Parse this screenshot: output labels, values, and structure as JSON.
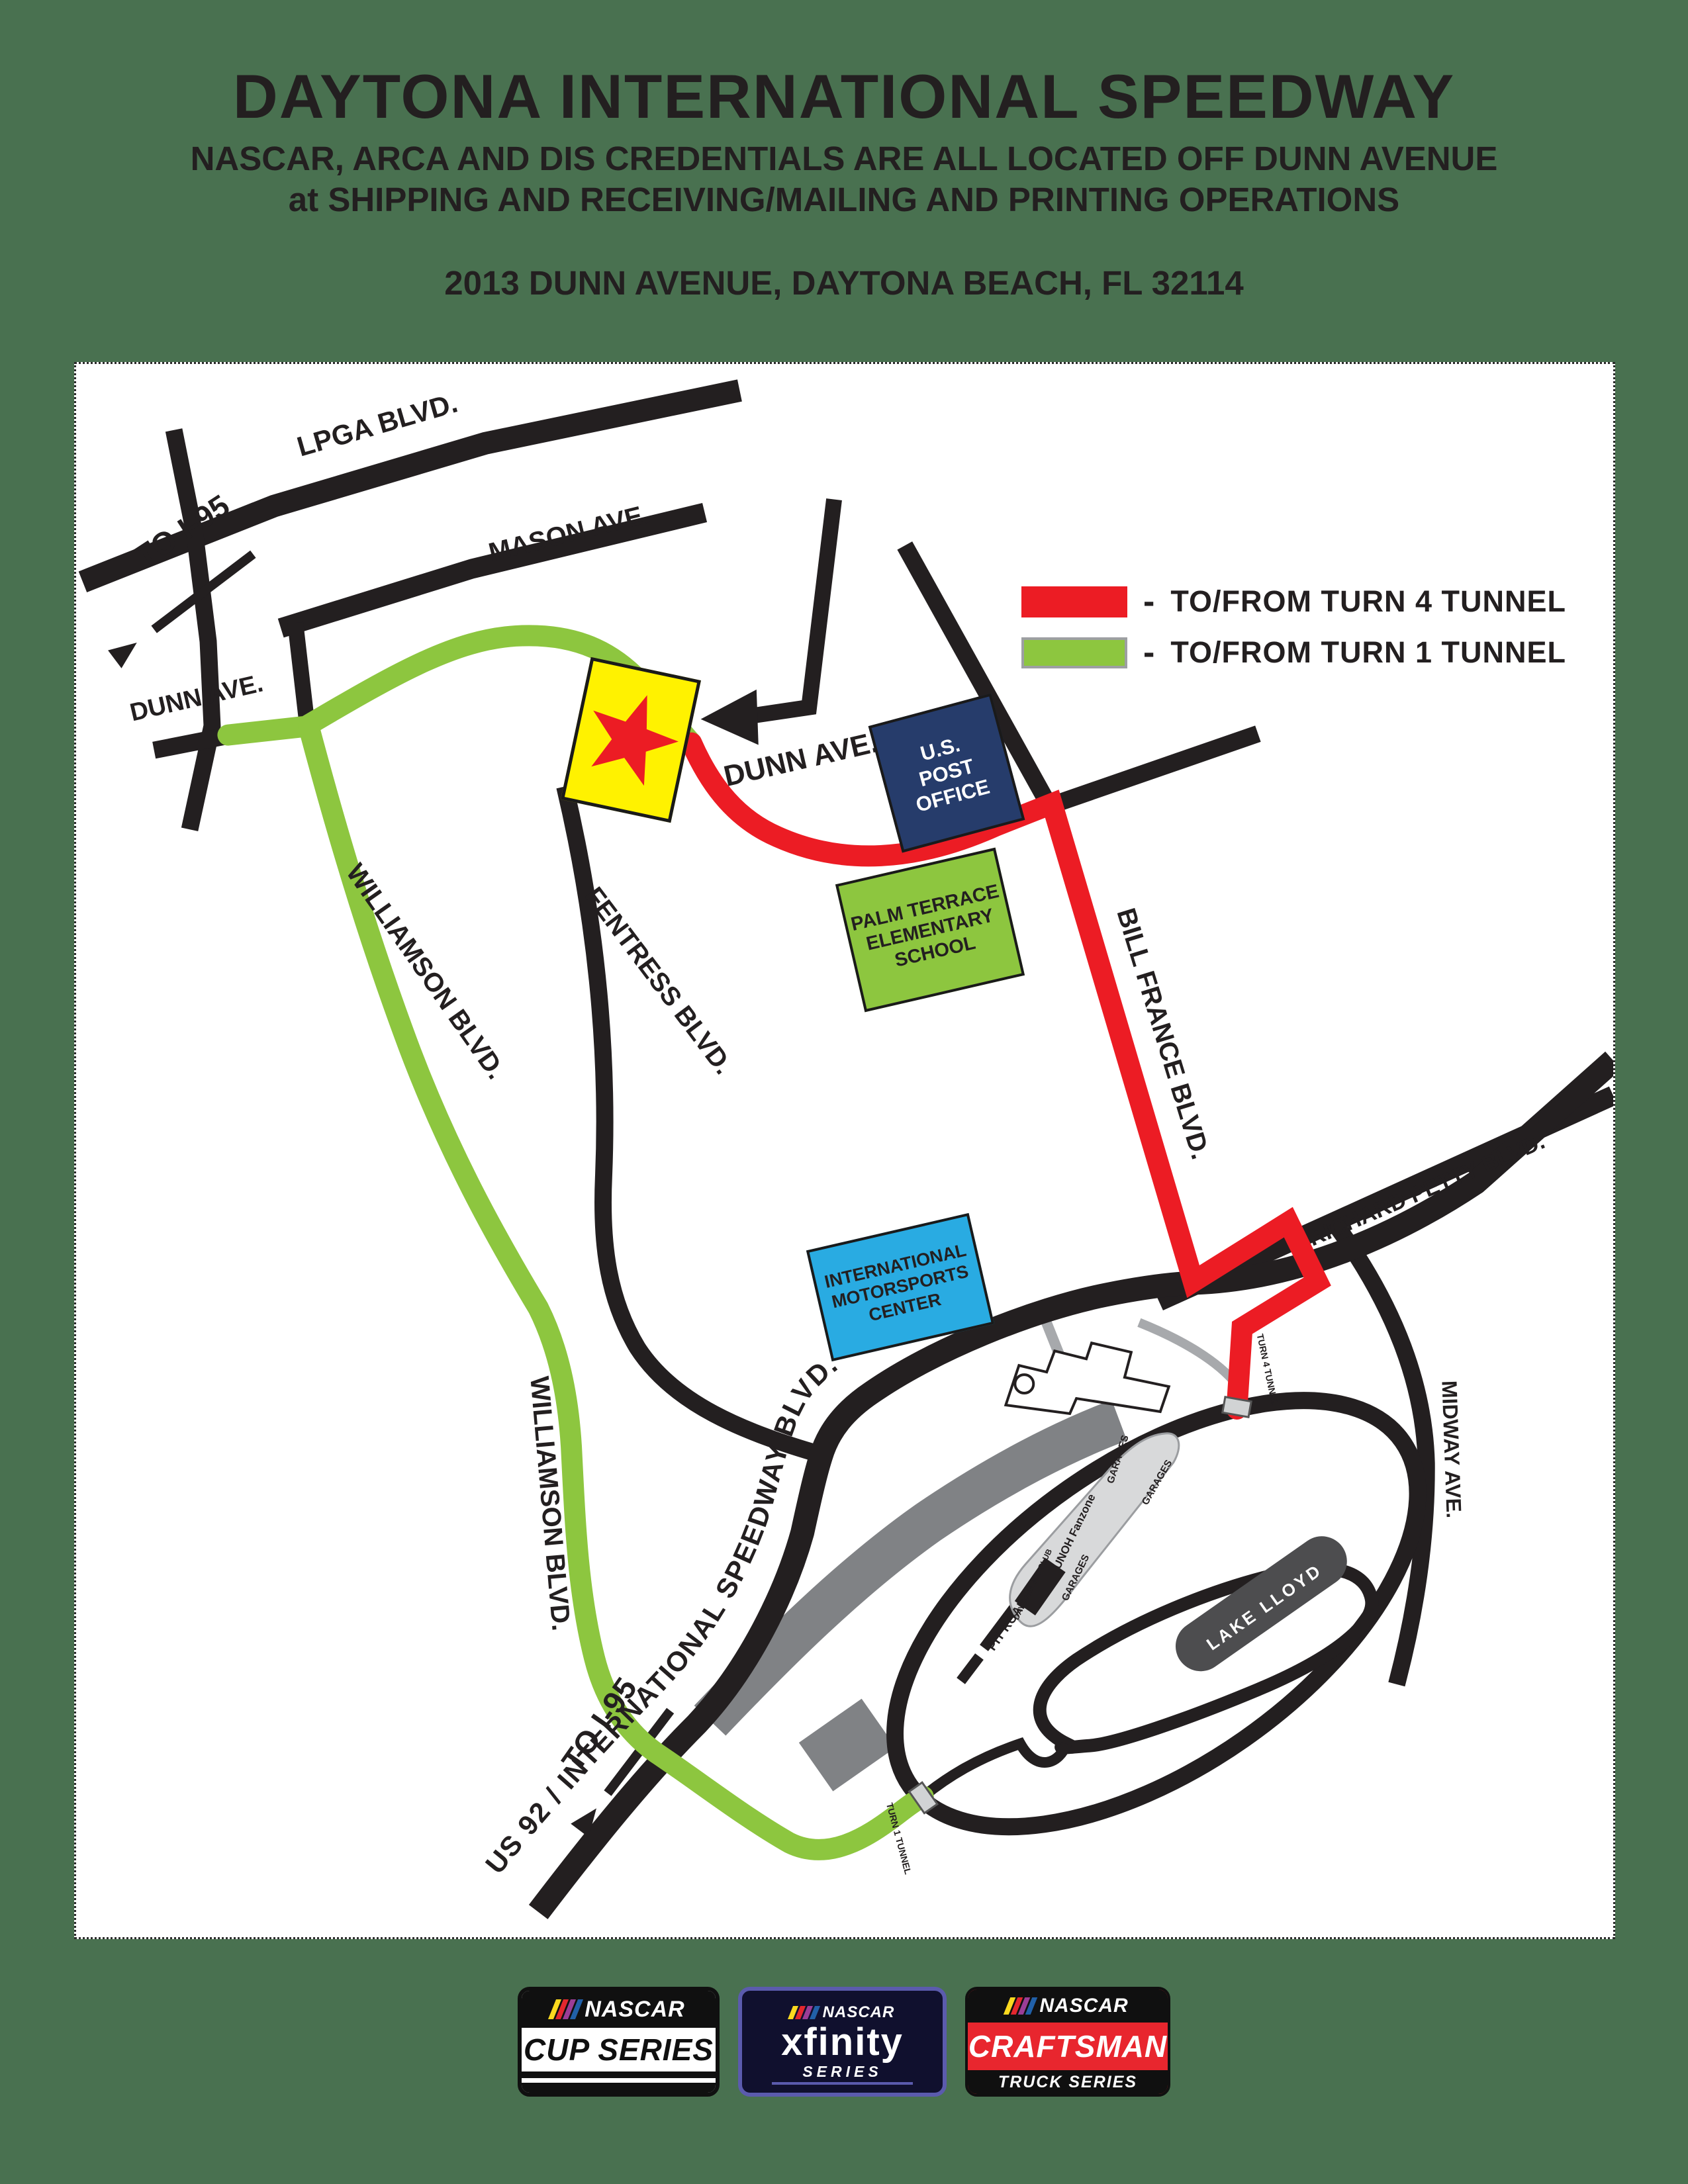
{
  "colors": {
    "page_bg": "#497150",
    "road_black": "#231f20",
    "route_turn4_red": "#ec1c24",
    "route_turn1_green": "#8dc63f",
    "post_office_bg": "#263c6b",
    "school_bg": "#8dc63f",
    "motorsports_bg": "#29abe2",
    "marker_bg": "#fff200",
    "marker_star": "#ec1c24",
    "grandstand_gray": "#808285",
    "infield_gray": "#d8d9da",
    "lake_gray": "#4d4d4f"
  },
  "header": {
    "title": "DAYTONA INTERNATIONAL SPEEDWAY",
    "subtitle_line1": "NASCAR, ARCA AND DIS CREDENTIALS ARE ALL LOCATED OFF DUNN AVENUE",
    "subtitle_line2": "at SHIPPING AND RECEIVING/MAILING AND PRINTING OPERATIONS",
    "address": "2013 DUNN AVENUE, DAYTONA BEACH, FL 32114"
  },
  "legend": {
    "separator": "-",
    "items": [
      {
        "color": "#ec1c24",
        "label": "TO/FROM TURN 4 TUNNEL"
      },
      {
        "color": "#8dc63f",
        "label": "TO/FROM TURN 1 TUNNEL"
      }
    ]
  },
  "map": {
    "roads": {
      "lpga": "LPGA BLVD.",
      "to_i95_top": "TO I-95",
      "mason": "MASON AVE.",
      "dunn_west": "DUNN AVE.",
      "dunn_east": "DUNN AVE.",
      "williamson_upper": "WILLIAMSON BLVD.",
      "williamson_lower": "WILLIAMSON BLVD.",
      "fentress": "FENTRESS BLVD.",
      "bill_france": "BILL FRANCE BLVD.",
      "richard_petty": "RICHARD PETTY BLVD.",
      "midway": "MIDWAY AVE.",
      "us92": "US 92 / INTERNATIONAL SPEEDWAY BLVD.",
      "to_i95_bottom": "TO I-95"
    },
    "places": {
      "post_office": {
        "lines": [
          "U.S.",
          "POST",
          "OFFICE"
        ]
      },
      "school": {
        "lines": [
          "PALM TERRACE",
          "ELEMENTARY",
          "SCHOOL"
        ]
      },
      "motorsports_center": {
        "lines": [
          "INTERNATIONAL",
          "MOTORSPORTS",
          "CENTER"
        ]
      }
    },
    "track": {
      "pit_road": "PIT ROAD",
      "garages_top": "GARAGES",
      "garages_right": "GARAGES",
      "garages_mid": "GARAGES",
      "unoh_fanzone": "UNOH Fanzone",
      "daytona_500_club": "DAYTONA 500 CLUB",
      "lake_lloyd": "LAKE LLOYD",
      "turn4_tunnel": "TURN 4 TUNNEL",
      "turn1_tunnel": "TURN 1 TUNNEL"
    }
  },
  "logos": {
    "cup": {
      "brand": "NASCAR",
      "series": "CUP SERIES"
    },
    "xfinity": {
      "brand": "NASCAR",
      "name": "xfinity",
      "series": "SERIES"
    },
    "craftsman": {
      "brand": "NASCAR",
      "name": "CRAFTSMAN",
      "series": "TRUCK SERIES"
    }
  }
}
